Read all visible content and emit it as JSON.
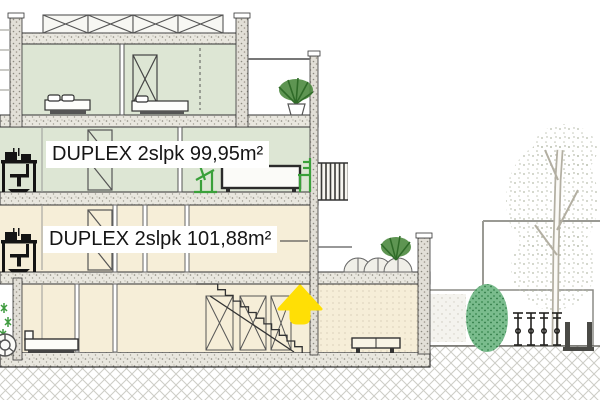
{
  "labels": {
    "upper_duplex": "DUPLEX 2slpk 99,95m²",
    "lower_duplex": "DUPLEX 2slpk 101,88m²"
  },
  "colors": {
    "interior_green": "#dde6d4",
    "interior_cream": "#f6eed8",
    "slab_gray": "#e9e7df",
    "arrow_yellow": "#ffdf05",
    "furniture_green": "#3aa03a",
    "bush_green": "#7abc8d",
    "line_dark": "#333333"
  },
  "elements": {
    "up_arrow": "highlight-up-arrow",
    "tree": "birch-tree",
    "bush": "garden-bush",
    "bikes": "bicycle-rack",
    "planter": "tree-planter",
    "balcony_plant": "potted-fern",
    "roof_plants": "terrace-planters",
    "log": "log-section",
    "stairs": "staircase"
  }
}
